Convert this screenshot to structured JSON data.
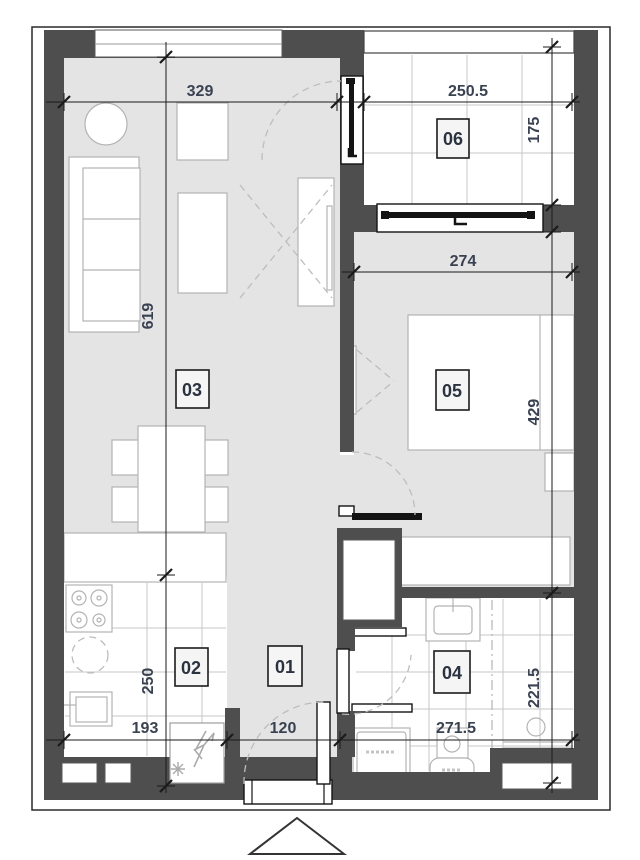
{
  "plan": {
    "type": "apartment-floor-plan",
    "rooms": [
      {
        "number": "01"
      },
      {
        "number": "02"
      },
      {
        "number": "03"
      },
      {
        "number": "04"
      },
      {
        "number": "05"
      },
      {
        "number": "06"
      }
    ],
    "dimensions_cm": {
      "living_width": "329",
      "terrace_width": "250.5",
      "terrace_depth": "175",
      "bedroom_width": "274",
      "living_length": "619",
      "bedroom_length": "429",
      "kitchen_length": "250",
      "kitchen_width": "193",
      "entry_width": "120",
      "bathroom_width": "271.5",
      "bathroom_depth": "221.5"
    },
    "colors": {
      "wall": "#4e4e4e",
      "floor": "#e4e4e4",
      "tile": "#ffffff",
      "dimension_text": "#3a4252"
    }
  }
}
